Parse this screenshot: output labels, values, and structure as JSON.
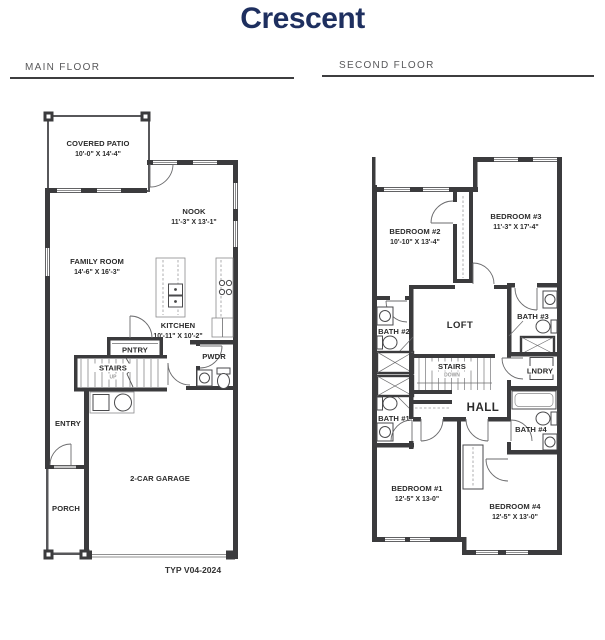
{
  "title": "Crescent",
  "colors": {
    "accent": "#1e2f5f",
    "heading": "#58585a",
    "wall": "#3b3b3d"
  },
  "sections": {
    "main_floor": {
      "label": "MAIN FLOOR",
      "plan_code": "TYP V04-2024",
      "rooms": {
        "covered_patio": {
          "name": "COVERED PATIO",
          "dims": "10'-0\" X 14'-4\""
        },
        "nook": {
          "name": "NOOK",
          "dims": "11'-3\" X 13'-1\""
        },
        "family_room": {
          "name": "FAMILY ROOM",
          "dims": "14'-6\" X 16'-3\""
        },
        "kitchen": {
          "name": "KITCHEN",
          "dims": "10'-11\" X 10'-2\""
        },
        "pantry": {
          "name": "PNTRY"
        },
        "stairs": {
          "name": "STAIRS",
          "direction": "UP"
        },
        "powder": {
          "name": "PWDR"
        },
        "entry": {
          "name": "ENTRY"
        },
        "porch": {
          "name": "PORCH"
        },
        "garage": {
          "name": "2-CAR GARAGE"
        }
      }
    },
    "second_floor": {
      "label": "SECOND FLOOR",
      "rooms": {
        "bedroom_2": {
          "name": "BEDROOM #2",
          "dims": "10'-10\" X 13'-4\""
        },
        "bedroom_3": {
          "name": "BEDROOM #3",
          "dims": "11'-3\" X 17'-4\""
        },
        "bath_2": {
          "name": "BATH #2"
        },
        "loft": {
          "name": "LOFT"
        },
        "bath_3": {
          "name": "BATH #3"
        },
        "stairs": {
          "name": "STAIRS",
          "direction": "DOWN"
        },
        "laundry": {
          "name": "LNDRY"
        },
        "hall": {
          "name": "HALL"
        },
        "bath_1": {
          "name": "BATH #1"
        },
        "bath_4": {
          "name": "BATH #4"
        },
        "bedroom_1": {
          "name": "BEDROOM #1",
          "dims": "12'-5\" X 13-0\""
        },
        "bedroom_4": {
          "name": "BEDROOM #4",
          "dims": "12'-5\" X 13'-0\""
        }
      }
    }
  }
}
